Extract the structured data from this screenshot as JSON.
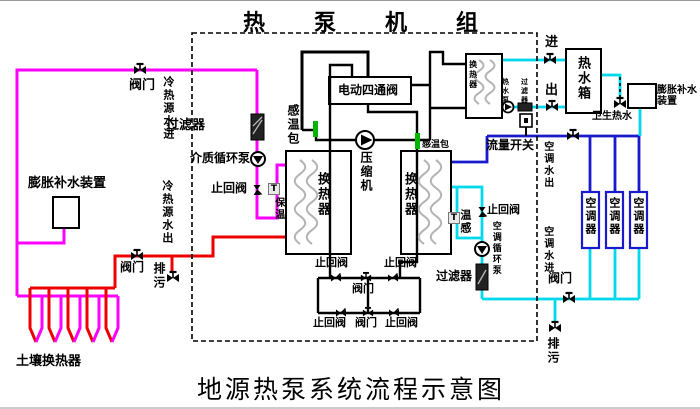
{
  "titles": {
    "top": "热泵机组",
    "bottom": "地源热泵系统流程示意图"
  },
  "colors": {
    "pipe-magenta": "#ff00ff",
    "pipe-red": "#ee0000",
    "pipe-blue": "#1a1acd",
    "pipe-cyan": "#00d8ee",
    "sensor-green": "#00b400",
    "coil-gray": "#b4b4b4"
  },
  "annotations": [
    {
      "name": "valve-source-supply-label",
      "text": "阀门",
      "x": 129,
      "y": 79,
      "size": 13
    },
    {
      "name": "source-water-in-label",
      "text": "冷热源水进",
      "x": 162,
      "y": 76,
      "size": 11,
      "vertical": true
    },
    {
      "name": "expansion-device-left-label",
      "text": "膨胀补水装置",
      "x": 28,
      "y": 177,
      "size": 13
    },
    {
      "name": "source-water-out-label",
      "text": "冷热源水出",
      "x": 161,
      "y": 180,
      "size": 11,
      "vertical": true
    },
    {
      "name": "filter-left-label",
      "text": "过滤器",
      "x": 166,
      "y": 119,
      "size": 13
    },
    {
      "name": "medium-pump-label",
      "text": "介质循环泵",
      "x": 190,
      "y": 152,
      "size": 12
    },
    {
      "name": "check-valve-left-label",
      "text": "止回阀",
      "x": 211,
      "y": 182,
      "size": 12
    },
    {
      "name": "insulation-label",
      "text": "保温",
      "x": 272,
      "y": 197,
      "size": 10,
      "vertical": true
    },
    {
      "name": "sensor-bulb-left-label",
      "text": "感温包",
      "x": 286,
      "y": 104,
      "size": 12,
      "vertical": true
    },
    {
      "name": "four-way-valve-label",
      "text": "电动四通阀",
      "x": 338,
      "y": 84,
      "size": 12
    },
    {
      "name": "compressor-label",
      "text": "压缩机",
      "x": 359,
      "y": 151,
      "size": 12,
      "vertical": true
    },
    {
      "name": "hx-left-label",
      "text": "换热器",
      "x": 315,
      "y": 172,
      "size": 13,
      "vertical": true
    },
    {
      "name": "hx-right-label",
      "text": "换热器",
      "x": 402,
      "y": 172,
      "size": 13,
      "vertical": true
    },
    {
      "name": "sensor-bulb-right-label",
      "text": "感温包",
      "x": 422,
      "y": 141,
      "size": 9
    },
    {
      "name": "hx-top-label",
      "text": "换热器",
      "x": 468,
      "y": 60,
      "size": 8,
      "vertical": true
    },
    {
      "name": "hw-pump-label",
      "text": "热水泵",
      "x": 501,
      "y": 78,
      "size": 7,
      "vertical": true
    },
    {
      "name": "hw-filter-label",
      "text": "过滤器",
      "x": 520,
      "y": 78,
      "size": 7,
      "vertical": true
    },
    {
      "name": "flow-switch-label",
      "text": "流量开关",
      "x": 486,
      "y": 139,
      "size": 12
    },
    {
      "name": "hw-in-label",
      "text": "进",
      "x": 545,
      "y": 36,
      "size": 13
    },
    {
      "name": "hw-out-label",
      "text": "出",
      "x": 545,
      "y": 84,
      "size": 13
    },
    {
      "name": "tank-label",
      "text": "热水箱",
      "x": 575,
      "y": 56,
      "size": 13,
      "vertical": true
    },
    {
      "name": "sanitary-hot-water-label",
      "text": "卫生热水",
      "x": 592,
      "y": 112,
      "size": 10
    },
    {
      "name": "expansion-device-right-label",
      "text": "膨胀补水\n装置",
      "x": 657,
      "y": 86,
      "size": 10
    },
    {
      "name": "ac-water-out-label",
      "text": "空调水出",
      "x": 541,
      "y": 141,
      "size": 10,
      "vertical": true
    },
    {
      "name": "ac-water-in-label",
      "text": "空调水进",
      "x": 541,
      "y": 226,
      "size": 10,
      "vertical": true
    },
    {
      "name": "temp-sensor-ac-label",
      "text": "温感",
      "x": 459,
      "y": 209,
      "size": 11,
      "vertical": true
    },
    {
      "name": "check-valve-ac-label",
      "text": "止回阀",
      "x": 487,
      "y": 204,
      "size": 11
    },
    {
      "name": "ac-pump-label",
      "text": "空调循环泵",
      "x": 490,
      "y": 221,
      "size": 9,
      "vertical": true
    },
    {
      "name": "ac-filter-label",
      "text": "过滤器",
      "x": 436,
      "y": 270,
      "size": 12
    },
    {
      "name": "valve-ac-header-label",
      "text": "阀门",
      "x": 548,
      "y": 272,
      "size": 12
    },
    {
      "name": "drain-ac-label",
      "text": "排污",
      "x": 546,
      "y": 337,
      "size": 12,
      "vertical": true
    },
    {
      "name": "ac-unit-1-label",
      "text": "空调器",
      "x": 584,
      "y": 197,
      "size": 11,
      "vertical": true
    },
    {
      "name": "ac-unit-2-label",
      "text": "空调器",
      "x": 608,
      "y": 197,
      "size": 11,
      "vertical": true
    },
    {
      "name": "ac-unit-3-label",
      "text": "空调器",
      "x": 632,
      "y": 197,
      "size": 11,
      "vertical": true
    },
    {
      "name": "bridge-check-top-left-label",
      "text": "止回阀",
      "x": 315,
      "y": 257,
      "size": 11
    },
    {
      "name": "bridge-check-top-right-label",
      "text": "止回阀",
      "x": 384,
      "y": 257,
      "size": 11
    },
    {
      "name": "bridge-valve-mid-label",
      "text": "阀门",
      "x": 352,
      "y": 283,
      "size": 11
    },
    {
      "name": "bridge-check-bottom-left-label",
      "text": "止回阀",
      "x": 313,
      "y": 317,
      "size": 11
    },
    {
      "name": "bridge-valve-bottom-label",
      "text": "阀门",
      "x": 355,
      "y": 317,
      "size": 11
    },
    {
      "name": "bridge-check-bottom-right-label",
      "text": "止回阀",
      "x": 385,
      "y": 317,
      "size": 11
    },
    {
      "name": "valve-source-return-label",
      "text": "阀门",
      "x": 120,
      "y": 261,
      "size": 12
    },
    {
      "name": "drain-source-label",
      "text": "排污",
      "x": 152,
      "y": 262,
      "size": 12,
      "vertical": true
    },
    {
      "name": "ground-hx-label",
      "text": "土壤换热器",
      "x": 16,
      "y": 355,
      "size": 13
    },
    {
      "name": "t-sensor-left",
      "text": "T",
      "x": 268,
      "y": 183,
      "size": 9,
      "box": true
    },
    {
      "name": "t-sensor-ac",
      "text": "T",
      "x": 448,
      "y": 212,
      "size": 9,
      "box": true
    }
  ]
}
